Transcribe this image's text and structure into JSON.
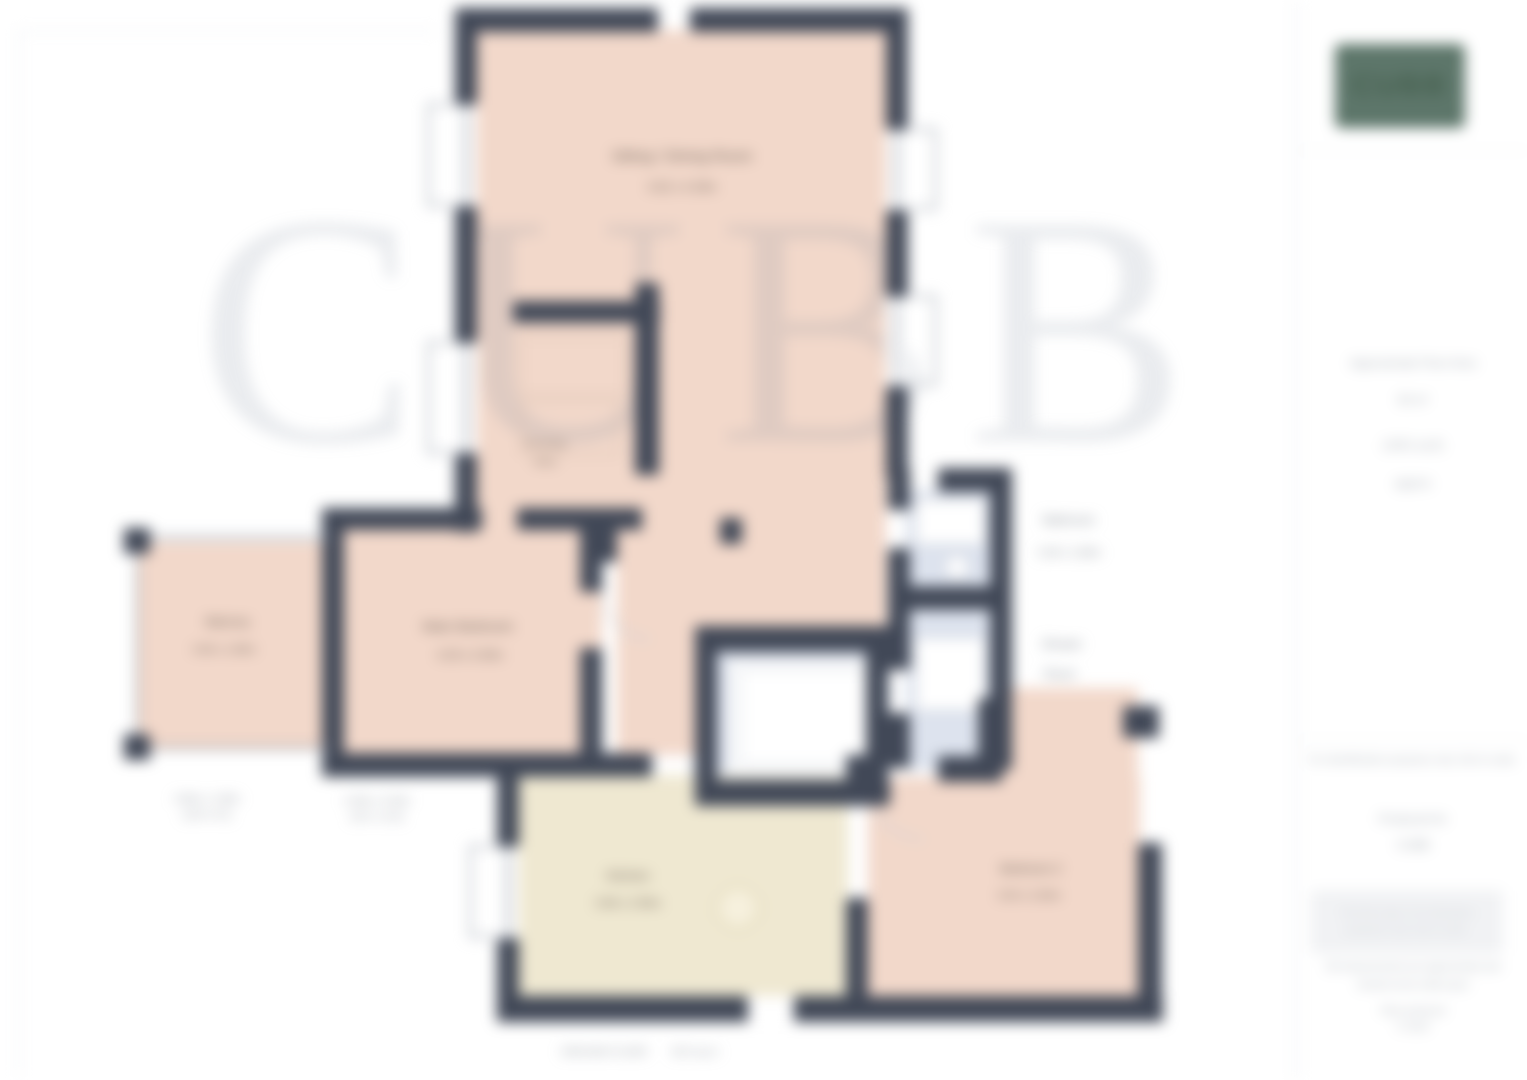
{
  "plan": {
    "watermark": "CUBB",
    "caption": {
      "part1": "GROUND FLOOR",
      "part2": "93.0 sq m"
    },
    "rooms": {
      "living": {
        "name": "Sitting / Dining Room",
        "dims": "4.62 x 4.29m"
      },
      "dressing": {
        "name": "Dressing",
        "dims": "Area"
      },
      "balcony": {
        "name": "Balcony",
        "dims": "3.96 x 1.86m"
      },
      "bedroom1": {
        "name": "Main Bedroom",
        "dims": "4.29 x 3.40m"
      },
      "bathroom": {
        "name": "Bathroom",
        "dims": "2.46 x 1.60m"
      },
      "shower": {
        "name": "Shower",
        "dims": "Room"
      },
      "kitchen": {
        "name": "Kitchen",
        "dims": "3.68 x 2.95m"
      },
      "bedroom2": {
        "name": "Bedroom 2",
        "dims": "3.50 x 2.84m"
      }
    },
    "dims_below": {
      "balcony_m": "3.96m x 1.86m",
      "balcony_ft": "(13'0 x 6'1)",
      "bedroom_m": "4.29m x 3.40m",
      "bedroom_ft": "(14'1 x 11'2)"
    }
  },
  "sidebar": {
    "logo_text": "CUBB",
    "area": {
      "line1": "Approximate Floor Area",
      "line2": "93 m²",
      "line3": "(1001 sq ft)",
      "line4": "approx"
    },
    "note": "For identification purposes only. Not to scale.",
    "produced": {
      "label": "Produced for",
      "value": "CUBB"
    },
    "box": {
      "line1": "This floor plan is for illustrative",
      "line2": "purposes only. Not to scale."
    },
    "footer": {
      "line1": "All measurements are approximate and",
      "line2": "should not be relied upon",
      "line3": "Plan produced",
      "line4": "© 2024"
    }
  }
}
